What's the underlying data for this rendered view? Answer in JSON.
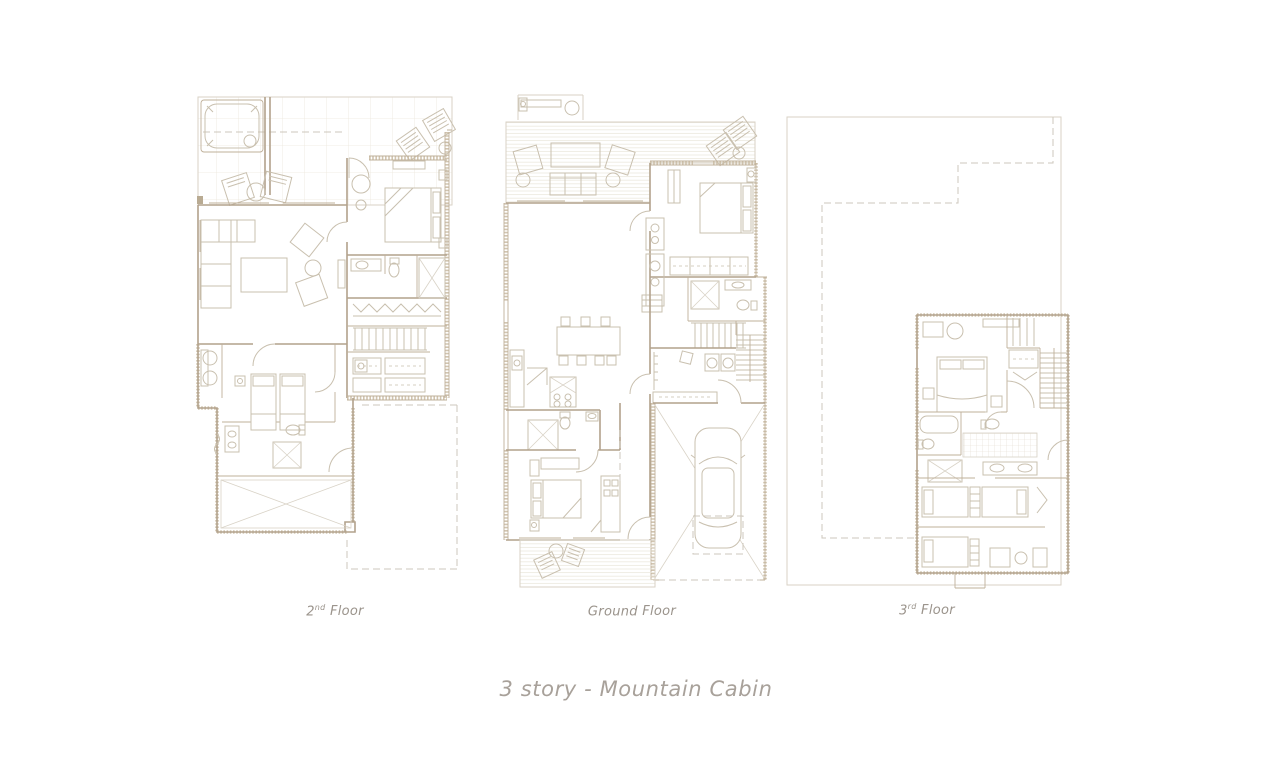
{
  "title": "3 story - Mountain Cabin",
  "floors": [
    {
      "id": "second",
      "label": {
        "prefix": "2",
        "sup": "nd",
        "word": "Floor"
      }
    },
    {
      "id": "ground",
      "label": {
        "prefix": "Ground",
        "sup": "",
        "word": "Floor"
      }
    },
    {
      "id": "third",
      "label": {
        "prefix": "3",
        "sup": "rd",
        "word": "Floor"
      }
    }
  ],
  "colors": {
    "background": "#ffffff",
    "wall_line": "#b2a28c",
    "furniture_line": "#c9c0af",
    "hatch_line": "#eae5da",
    "dashed_line": "#cdc7bc",
    "label_text": "#9b948c",
    "title_text": "#a8a19a"
  }
}
